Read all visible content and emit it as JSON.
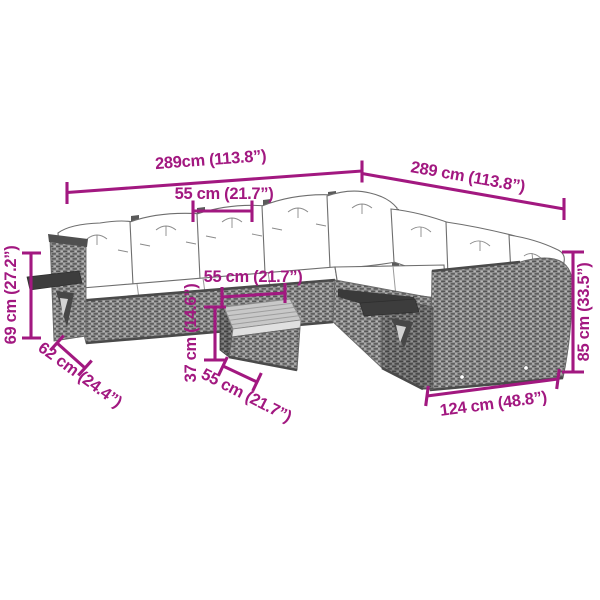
{
  "diagram": {
    "subject": "garden-lounge-set-dimension-diagram"
  },
  "colors": {
    "accent": "#A21880",
    "outline": "#6E6E6E",
    "rattan_base": "#8F8F8F",
    "rattan_dark": "#565656",
    "rattan_light": "#B7B7B7",
    "cushion": "#FFFFFF",
    "tray": "#3D3D3D",
    "table_top": "#C8C8C8",
    "background": "#FFFFFF"
  },
  "dimensions": {
    "overall_width_left": {
      "label": "289cm (113.8”)"
    },
    "overall_width_right": {
      "label": "289 cm (113.8”)"
    },
    "seat_width_back": {
      "label": "55 cm (21.7”)"
    },
    "armrest_height_left": {
      "label": "69 cm (27.2”)"
    },
    "seat_depth_left": {
      "label": "62 cm (24.4”)"
    },
    "table_width": {
      "label": "55 cm (21.7”)"
    },
    "table_height": {
      "label": "37 cm (14.6”)"
    },
    "table_depth": {
      "label": "55 cm (21.7”)"
    },
    "sofa_height_right": {
      "label": "85 cm (33.5”)"
    },
    "section_width_right": {
      "label": "124 cm (48.8”)"
    }
  }
}
